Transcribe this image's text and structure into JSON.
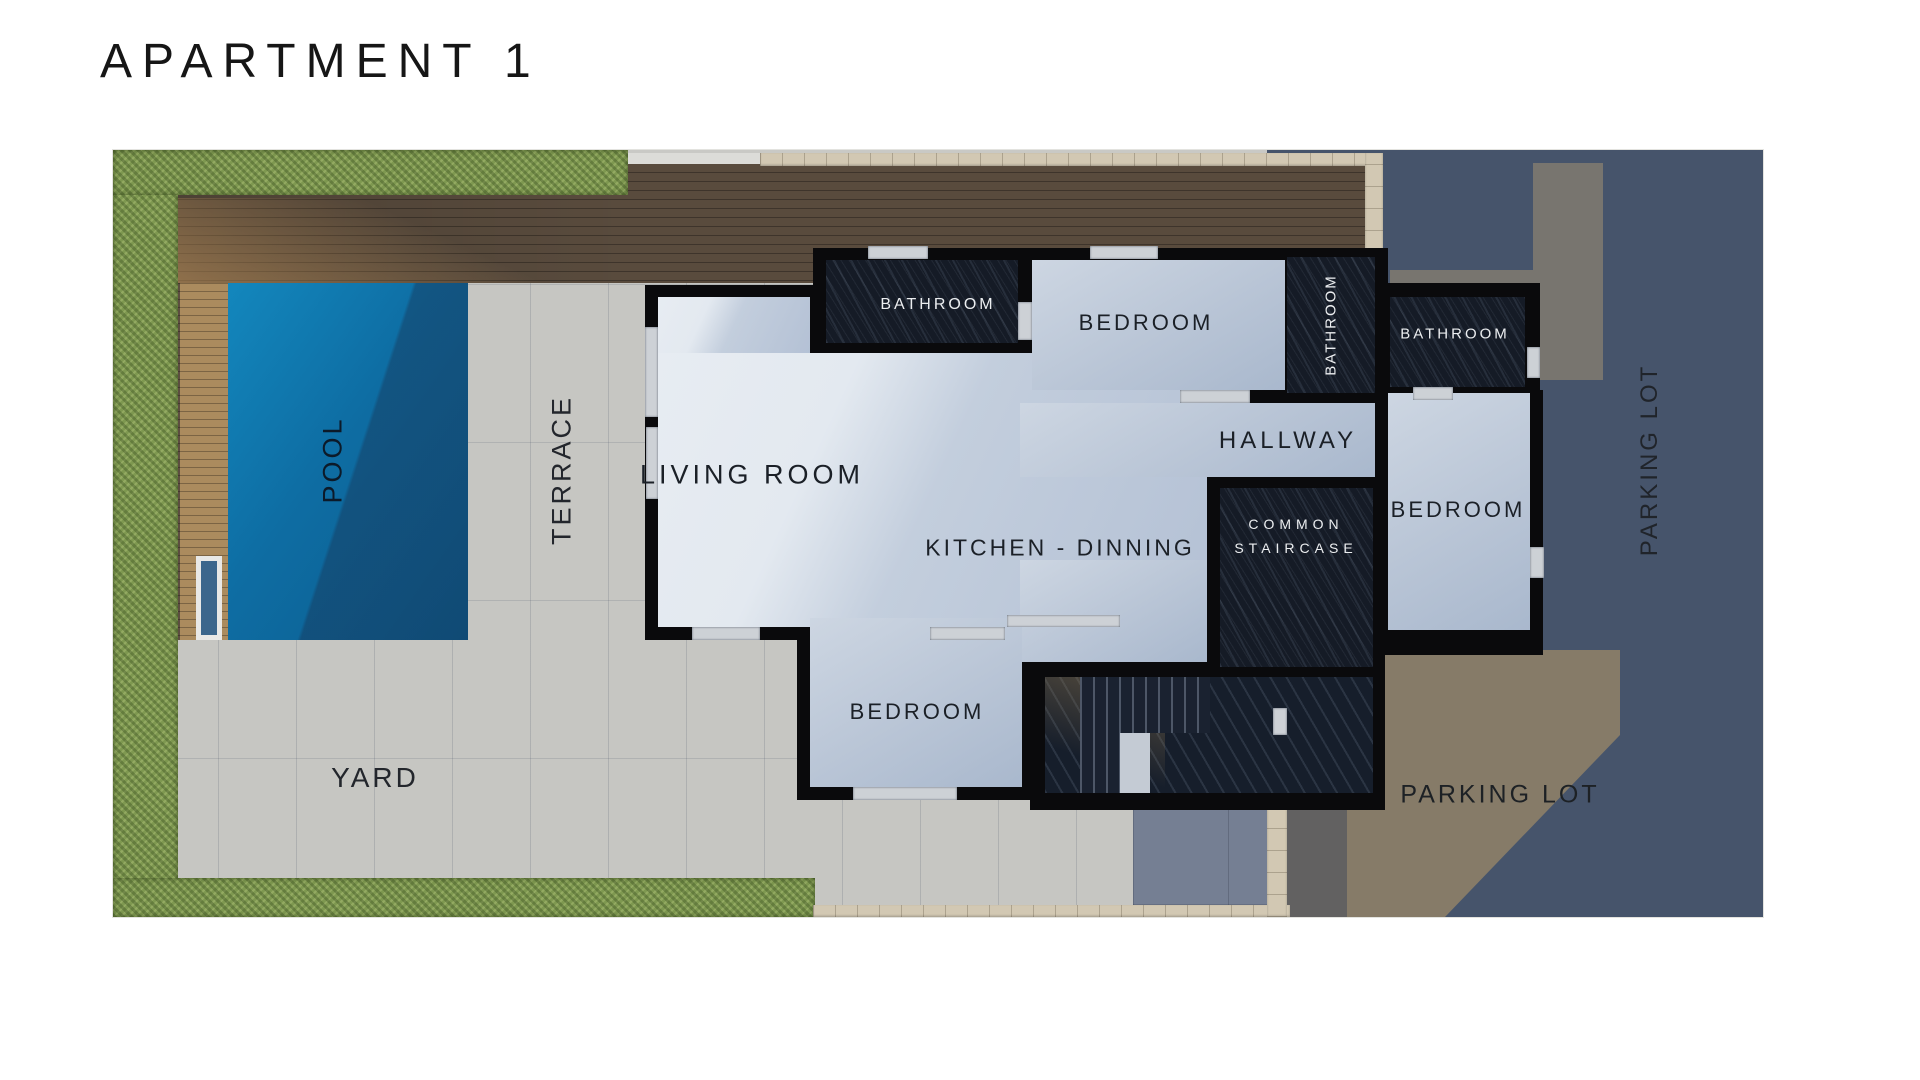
{
  "title": "APARTMENT 1",
  "labels": {
    "pool": "POOL",
    "terrace": "TERRACE",
    "yard": "YARD",
    "living_room": "LIVING ROOM",
    "kitchen_dining": "KITCHEN - DINNING",
    "hallway": "HALLWAY",
    "bathroom_top": "BATHROOM",
    "bathroom_mid": "BATHROOM",
    "bathroom_right": "BATHROOM",
    "bedroom_top": "BEDROOM",
    "bedroom_right": "BEDROOM",
    "bedroom_bottom": "BEDROOM",
    "staircase_line1": "COMMON",
    "staircase_line2": "STAIRCASE",
    "parking_bottom": "PARKING LOT",
    "parking_right": "PARKING LOT"
  },
  "colors": {
    "wall": "#0a0a0c",
    "pool_blue": "#0e6da3",
    "hedge_green": "#7e9850",
    "deck_wood_dark": "#594b3d",
    "deck_wood_light": "#ab8b5e",
    "marble_light": "#c7d1df",
    "marble_dark": "#151b26",
    "tile_sun": "#cbcac5",
    "tile_shadow": "#98a1b3",
    "parking_dark": "#46546b",
    "parking_lit": "#867b68",
    "stone_wall": "#d2c8b3"
  }
}
